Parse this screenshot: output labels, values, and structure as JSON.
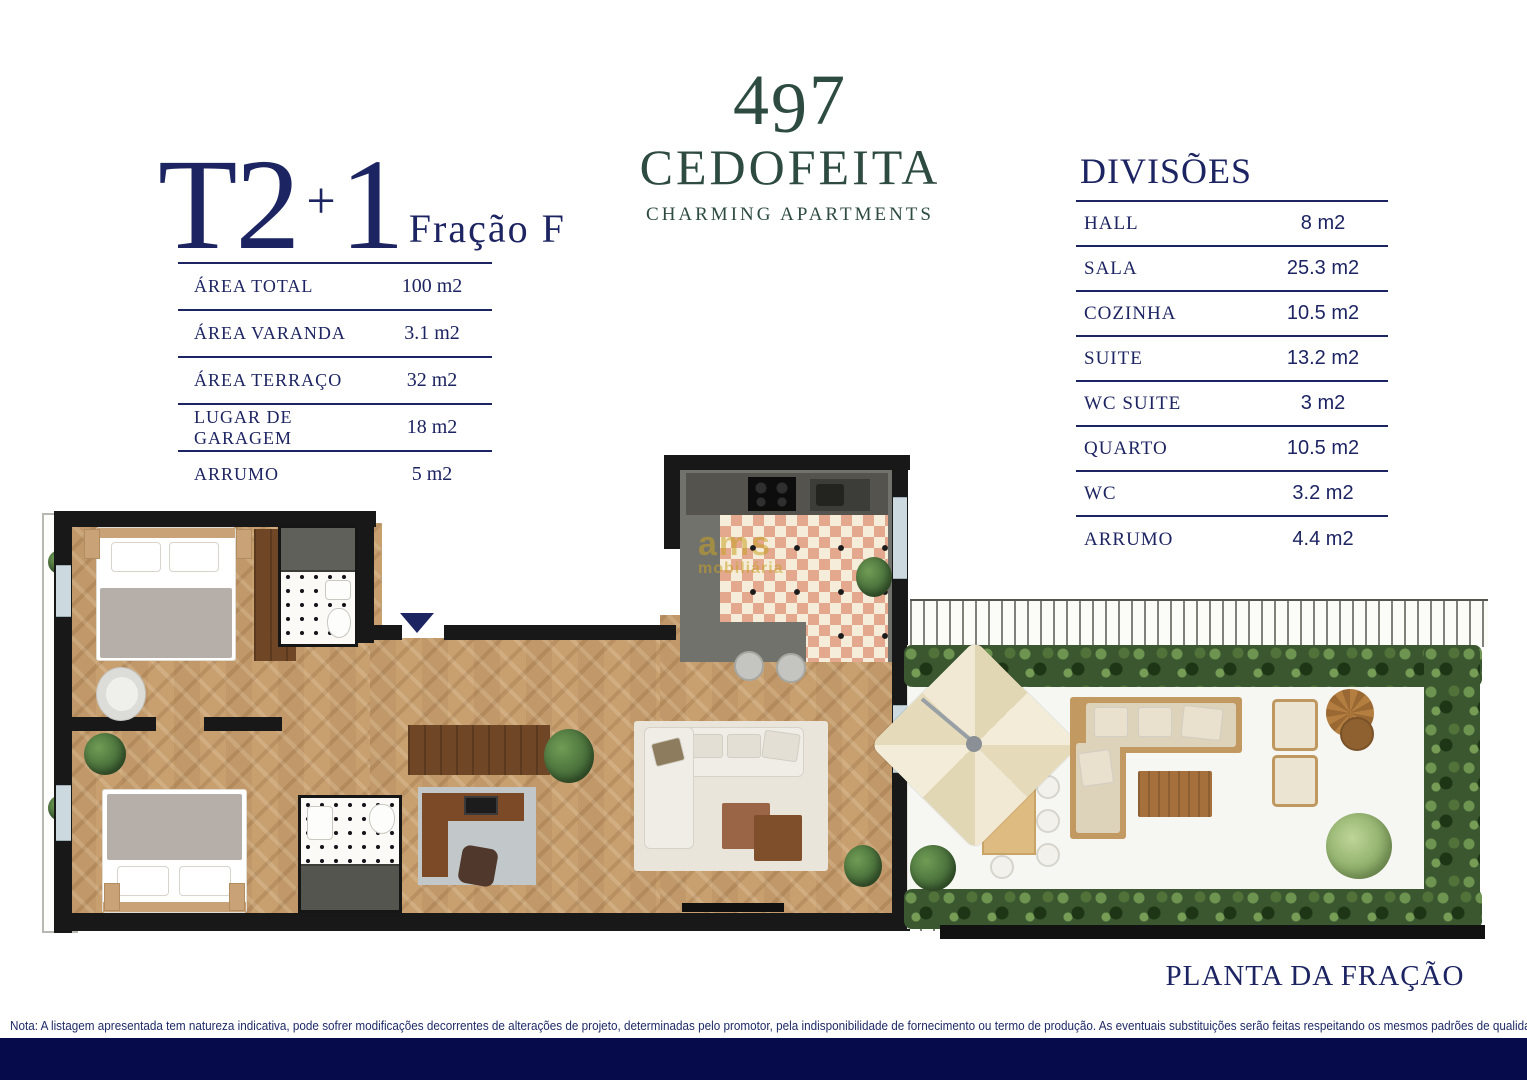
{
  "title": {
    "main": "T2",
    "plus": "+",
    "one": "1",
    "sub": "Fração F"
  },
  "logo": {
    "digit1": "4",
    "digit2": "9",
    "digit3": "7",
    "name": "CEDOFEITA",
    "tagline": "CHARMING APARTMENTS"
  },
  "area_table": {
    "rows": [
      {
        "label": "ÁREA TOTAL",
        "value": "100 m2"
      },
      {
        "label": "ÁREA VARANDA",
        "value": "3.1 m2"
      },
      {
        "label": "ÁREA TERRAÇO",
        "value": "32 m2"
      },
      {
        "label": "LUGAR DE GARAGEM",
        "value": "18 m2"
      },
      {
        "label": "ARRUMO",
        "value": "5 m2"
      }
    ]
  },
  "divisions": {
    "heading": "DIVISÕES",
    "rows": [
      {
        "label": "HALL",
        "value": "8 m2"
      },
      {
        "label": "SALA",
        "value": "25.3 m2"
      },
      {
        "label": "COZINHA",
        "value": "10.5 m2"
      },
      {
        "label": "SUITE",
        "value": "13.2 m2"
      },
      {
        "label": "WC SUITE",
        "value": "3 m2"
      },
      {
        "label": "QUARTO",
        "value": "10.5 m2"
      },
      {
        "label": "WC",
        "value": "3.2 m2"
      },
      {
        "label": "ARRUMO",
        "value": "4.4 m2"
      }
    ]
  },
  "plan": {
    "caption": "PLANTA DA FRAÇÃO",
    "watermark_line1": "ams",
    "watermark_line2": "mobiliária"
  },
  "note": "Nota: A listagem apresentada tem natureza indicativa, pode sofrer modificações decorrentes de alterações de projeto, determinadas pelo promotor, pela indisponibilidade de fornecimento ou termo de produção. As eventuais substituições serão feitas respeitando os mesmos padrões de qualidade.",
  "colors": {
    "navy": "#1d2462",
    "green": "#2e4b41",
    "footer": "#060b4c"
  }
}
